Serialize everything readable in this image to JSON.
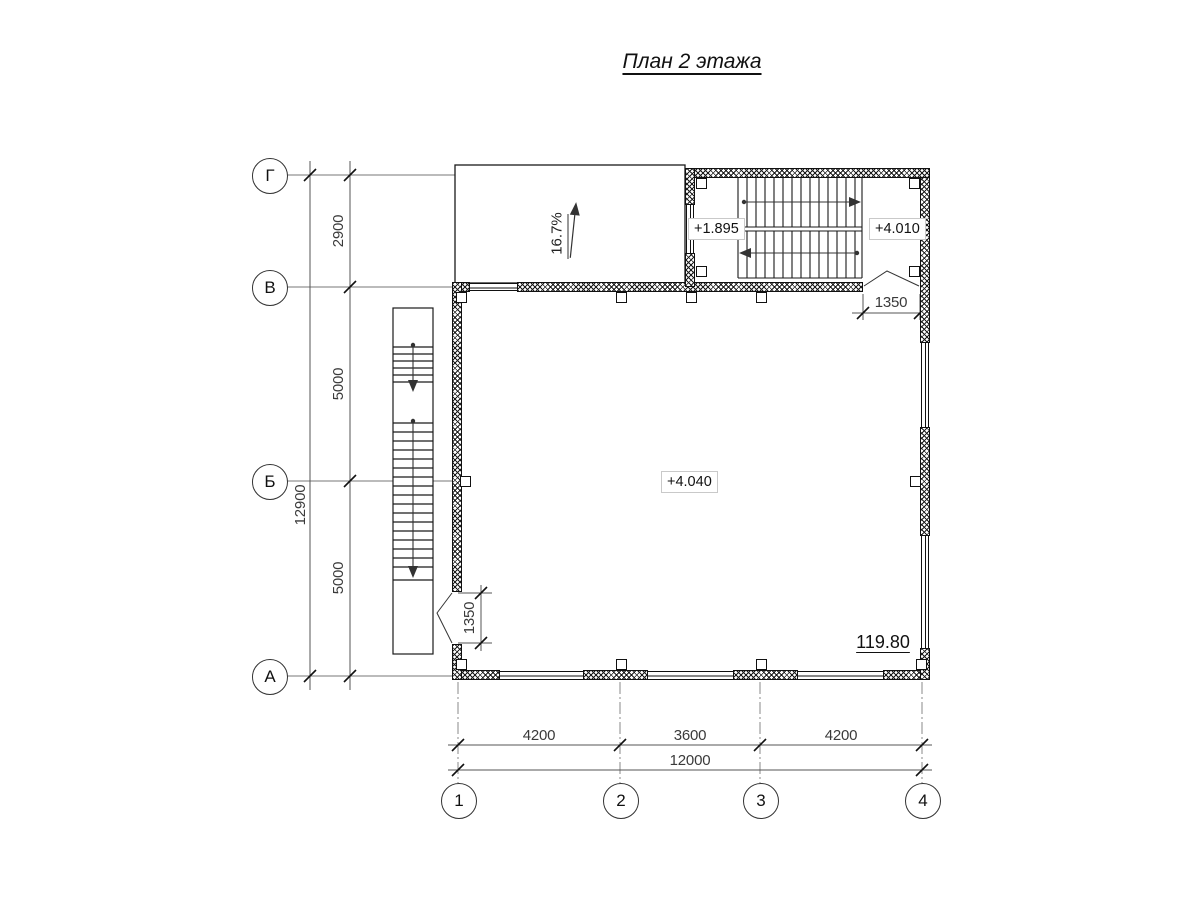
{
  "title": "План 2 этажа",
  "axes": {
    "rows": [
      "Г",
      "В",
      "Б",
      "А"
    ],
    "cols": [
      "1",
      "2",
      "3",
      "4"
    ]
  },
  "dims": {
    "row_segments": [
      "2900",
      "5000",
      "5000"
    ],
    "row_total": "12900",
    "col_segments": [
      "4200",
      "3600",
      "4200"
    ],
    "col_total": "12000",
    "door_top": "1350",
    "door_bottom": "1350"
  },
  "marks": {
    "slope": "16.7%",
    "stair_mid_landing": "+1.895",
    "stair_top_landing": "+4.010",
    "floor_level": "+4.040",
    "room_area": "119.80"
  },
  "colors": {
    "line": "#1a1a1a",
    "dim_line": "#555555",
    "axis_line": "#888888",
    "text": "#222222"
  }
}
